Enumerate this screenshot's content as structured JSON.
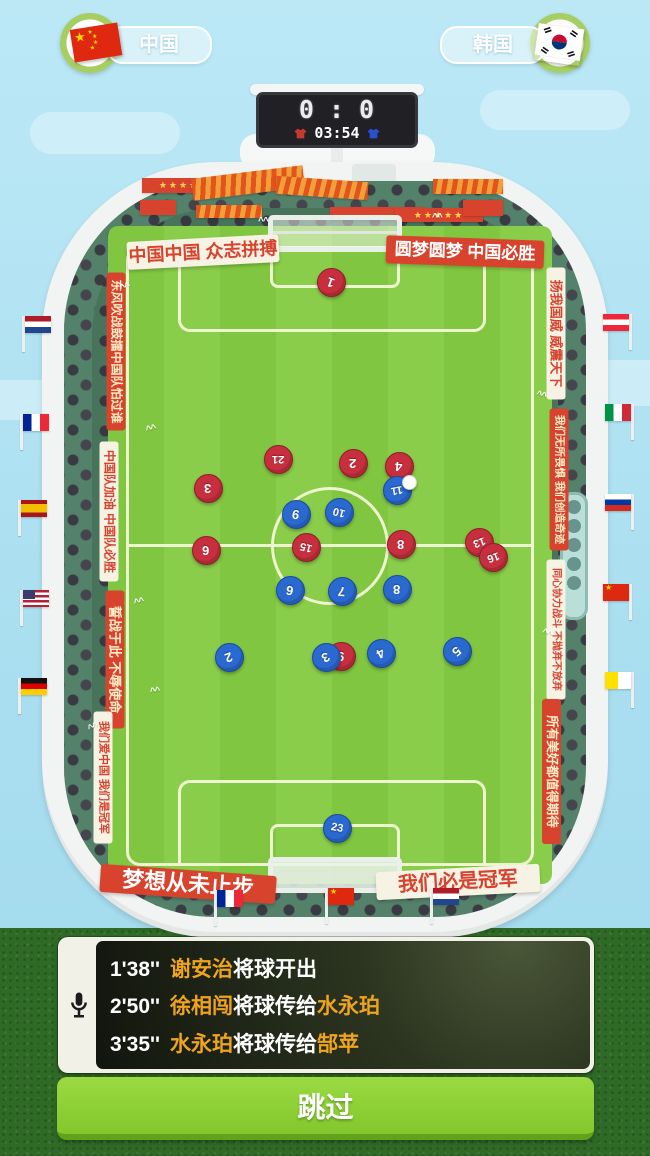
{
  "teams": {
    "home": {
      "name": "中国",
      "flag": "china"
    },
    "away": {
      "name": "韩国",
      "flag": "south-korea"
    }
  },
  "scoreboard": {
    "home_score": "0",
    "separator": ":",
    "away_score": "0",
    "time": "03:54"
  },
  "stadium": {
    "banners": {
      "top_left": {
        "style": "white",
        "text": "中国中国 众志拼搏"
      },
      "top_right": {
        "style": "red",
        "text": "圆梦圆梦 中国必胜"
      },
      "bottom_left": {
        "style": "red",
        "text": "梦想从未止步"
      },
      "bottom_right": {
        "style": "white",
        "text": "我们必是冠军"
      },
      "left_side": [
        {
          "style": "red",
          "text": "东风吹战鼓擂中国队怕过谁"
        },
        {
          "style": "white",
          "text": "中国队加油 中国队必胜"
        },
        {
          "style": "red",
          "text": "誓战于此 不辱使命"
        },
        {
          "style": "white",
          "text": "我们爱中国 我们是冠军"
        }
      ],
      "right_side": [
        {
          "style": "white",
          "text": "扬我国威 威震天下"
        },
        {
          "style": "red",
          "text": "我们无所畏惧 我们创造奇迹"
        },
        {
          "style": "white",
          "text": "同心协力战斗 不抛弃不放弃"
        },
        {
          "style": "red",
          "text": "所有美好都值得期待"
        }
      ]
    },
    "flags": [
      {
        "country": "netherlands",
        "side": "left",
        "x": 22,
        "y": 316
      },
      {
        "country": "france",
        "side": "left",
        "x": 20,
        "y": 414
      },
      {
        "country": "spain",
        "side": "left",
        "x": 18,
        "y": 500
      },
      {
        "country": "usa",
        "side": "left",
        "x": 20,
        "y": 590
      },
      {
        "country": "germany",
        "side": "left",
        "x": 18,
        "y": 678
      },
      {
        "country": "austria",
        "side": "right",
        "x": 600,
        "y": 314
      },
      {
        "country": "italy",
        "side": "right",
        "x": 602,
        "y": 404
      },
      {
        "country": "russia",
        "side": "right",
        "x": 602,
        "y": 494
      },
      {
        "country": "china",
        "side": "right",
        "x": 600,
        "y": 584
      },
      {
        "country": "yellow-white",
        "side": "right",
        "x": 602,
        "y": 672
      },
      {
        "country": "france",
        "side": "bottom",
        "x": 214,
        "y": 890
      },
      {
        "country": "china",
        "side": "bottom",
        "x": 325,
        "y": 888
      },
      {
        "country": "netherlands",
        "side": "bottom",
        "x": 430,
        "y": 888
      }
    ],
    "decor": {
      "stars": "★★★★★",
      "cheer": "^^",
      "star": "★"
    }
  },
  "pitch": {
    "players": [
      {
        "team": "red",
        "number": "1",
        "x": 330,
        "y": 281,
        "rot": 200
      },
      {
        "team": "red",
        "number": "21",
        "x": 277,
        "y": 458,
        "rot": 180
      },
      {
        "team": "red",
        "number": "2",
        "x": 352,
        "y": 462,
        "rot": 180
      },
      {
        "team": "red",
        "number": "4",
        "x": 398,
        "y": 465,
        "rot": 185
      },
      {
        "team": "red",
        "number": "3",
        "x": 207,
        "y": 487,
        "rot": 180
      },
      {
        "team": "red",
        "number": "6",
        "x": 205,
        "y": 549,
        "rot": 180
      },
      {
        "team": "red",
        "number": "15",
        "x": 305,
        "y": 546,
        "rot": 195
      },
      {
        "team": "red",
        "number": "8",
        "x": 400,
        "y": 543,
        "rot": 180
      },
      {
        "team": "red",
        "number": "13",
        "x": 478,
        "y": 541,
        "rot": 160
      },
      {
        "team": "red",
        "number": "16",
        "x": 492,
        "y": 556,
        "rot": 160
      },
      {
        "team": "red",
        "number": "9",
        "x": 340,
        "y": 655,
        "rot": 185
      },
      {
        "team": "blue",
        "number": "11",
        "x": 396,
        "y": 489,
        "rot": 170
      },
      {
        "team": "blue",
        "number": "9",
        "x": 295,
        "y": 513,
        "rot": 190
      },
      {
        "team": "blue",
        "number": "10",
        "x": 338,
        "y": 511,
        "rot": 195
      },
      {
        "team": "blue",
        "number": "6",
        "x": 289,
        "y": 589,
        "rot": 190
      },
      {
        "team": "blue",
        "number": "7",
        "x": 341,
        "y": 590,
        "rot": 185
      },
      {
        "team": "blue",
        "number": "8",
        "x": 396,
        "y": 588,
        "rot": 180
      },
      {
        "team": "blue",
        "number": "2",
        "x": 228,
        "y": 656,
        "rot": 160
      },
      {
        "team": "blue",
        "number": "3",
        "x": 325,
        "y": 656,
        "rot": 150
      },
      {
        "team": "blue",
        "number": "4",
        "x": 380,
        "y": 652,
        "rot": 150
      },
      {
        "team": "blue",
        "number": "5",
        "x": 456,
        "y": 650,
        "rot": 140
      },
      {
        "team": "blue",
        "number": "23",
        "x": 336,
        "y": 827,
        "rot": 10
      }
    ],
    "ball": {
      "x": 408,
      "y": 481
    }
  },
  "commentary": {
    "lines": [
      {
        "time": "1'38''",
        "segments": [
          {
            "text": "谢安治",
            "hl": true
          },
          {
            "text": "将球开出",
            "hl": false
          }
        ]
      },
      {
        "time": "2'50''",
        "segments": [
          {
            "text": "徐相闯",
            "hl": true
          },
          {
            "text": "将球传给",
            "hl": false
          },
          {
            "text": "水永珀",
            "hl": true
          }
        ]
      },
      {
        "time": "3'35''",
        "segments": [
          {
            "text": "水永珀",
            "hl": true
          },
          {
            "text": "将球传给",
            "hl": false
          },
          {
            "text": "郜苹",
            "hl": true
          }
        ]
      }
    ]
  },
  "skip_button": {
    "label": "跳过"
  },
  "colors": {
    "red_team": "#c72f3e",
    "blue_team": "#2a69cf",
    "banner_red": "#d8432e",
    "highlight": "#efa41f",
    "button_green": "#8ccf35"
  }
}
